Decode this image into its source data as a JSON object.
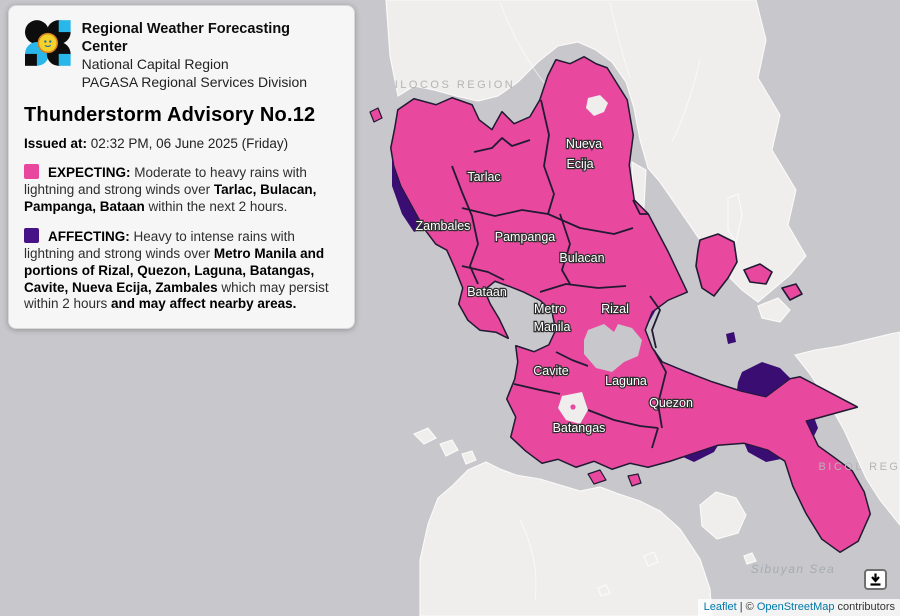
{
  "panel": {
    "org": {
      "line1": "Regional Weather Forecasting Center",
      "line2": "National Capital Region",
      "line3": "PAGASA Regional Services Division"
    },
    "title": "Thunderstorm Advisory No.12",
    "issued_label": "Issued at:",
    "issued_value": "02:32 PM, 06 June 2025 (Friday)",
    "legend": [
      {
        "key": "expecting",
        "label": "EXPECTING:",
        "color": "#E8479D",
        "segments": [
          {
            "t": " Moderate to heavy rains with lightning and strong winds over ",
            "b": false
          },
          {
            "t": "Tarlac, Bulacan, Pampanga, Bataan",
            "b": true
          },
          {
            "t": " within the next 2 hours.",
            "b": false
          }
        ]
      },
      {
        "key": "affecting",
        "label": "AFFECTING:",
        "color": "#471286",
        "segments": [
          {
            "t": " Heavy to intense rains with lightning and strong winds over ",
            "b": false
          },
          {
            "t": "Metro Manila and portions of Rizal, Quezon, Laguna, Batangas, Cavite, Nueva Ecija, Zambales",
            "b": true
          },
          {
            "t": " which may persist within 2 hours ",
            "b": false
          },
          {
            "t": "and may affect nearby areas.",
            "b": true
          }
        ]
      }
    ]
  },
  "map": {
    "colors": {
      "water": "#C8C8CC",
      "land": "#EFEEEC",
      "land_stroke": "#FBFBFA",
      "expecting": "#E8489D",
      "affecting": "#3A0D72",
      "border": "#201A33"
    },
    "province_labels": [
      {
        "text": "Nueva",
        "x": 584,
        "y": 144
      },
      {
        "text": "Ecija",
        "x": 580,
        "y": 164
      },
      {
        "text": "Tarlac",
        "x": 484,
        "y": 177
      },
      {
        "text": "Zambales",
        "x": 443,
        "y": 226
      },
      {
        "text": "Pampanga",
        "x": 525,
        "y": 237
      },
      {
        "text": "Bulacan",
        "x": 582,
        "y": 258
      },
      {
        "text": "Bataan",
        "x": 487,
        "y": 292
      },
      {
        "text": "Metro",
        "x": 550,
        "y": 309
      },
      {
        "text": "Manila",
        "x": 552,
        "y": 327
      },
      {
        "text": "Rizal",
        "x": 615,
        "y": 309
      },
      {
        "text": "Cavite",
        "x": 551,
        "y": 371
      },
      {
        "text": "Laguna",
        "x": 626,
        "y": 381
      },
      {
        "text": "Quezon",
        "x": 671,
        "y": 403
      },
      {
        "text": "Batangas",
        "x": 579,
        "y": 428
      }
    ],
    "region_labels": [
      {
        "text": "ILOCOS REGION",
        "x": 455,
        "y": 84,
        "kind": "region"
      },
      {
        "text": "BICOL REGION",
        "x": 873,
        "y": 466,
        "kind": "region",
        "anchor": "start"
      },
      {
        "text": "Sibuyan Sea",
        "x": 793,
        "y": 569,
        "kind": "sea"
      }
    ],
    "attribution": {
      "leaflet": "Leaflet",
      "sep": " | © ",
      "osm": "OpenStreetMap",
      "suffix": " contributors"
    }
  }
}
